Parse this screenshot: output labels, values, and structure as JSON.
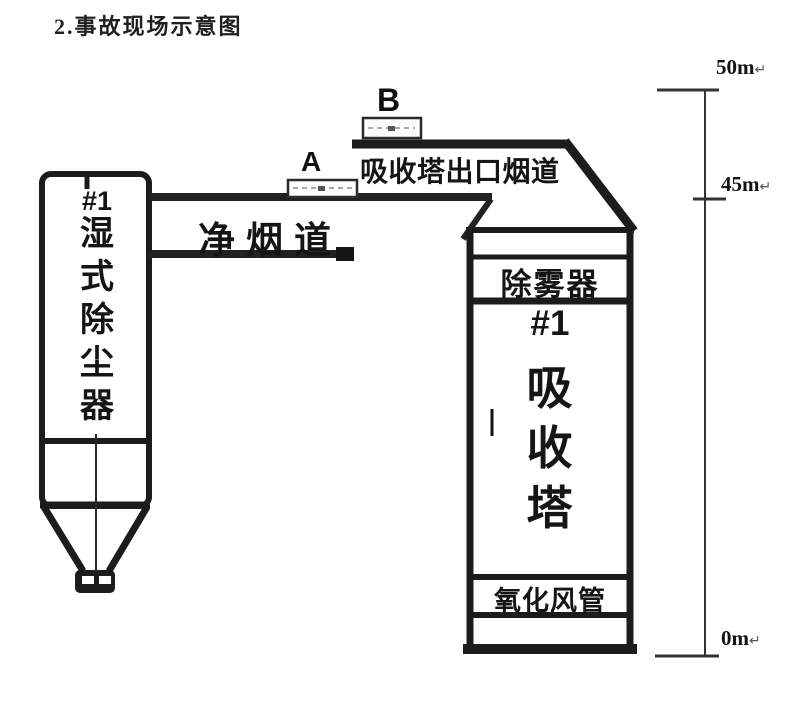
{
  "title": "2.事故现场示意图",
  "wet_esp": {
    "unit": "#1",
    "name_vertical": "湿\n式\n除\n尘\n器"
  },
  "ducts": {
    "clean_flue_label": "净烟道",
    "outlet_flue_label": "吸收塔出口烟道"
  },
  "markers": {
    "a": "A",
    "b": "B"
  },
  "tower": {
    "demister_label": "除雾器",
    "unit": "#1",
    "name_vertical": "吸\n收\n塔",
    "oxidation_duct_label": "氧化风管"
  },
  "elevations": [
    {
      "label": "50m",
      "mark": "↵"
    },
    {
      "label": "45m",
      "mark": "↵"
    },
    {
      "label": "0m",
      "mark": "↵"
    }
  ],
  "colors": {
    "line": "#1c1c1c",
    "scale_line": "#333333",
    "text": "#151515"
  }
}
